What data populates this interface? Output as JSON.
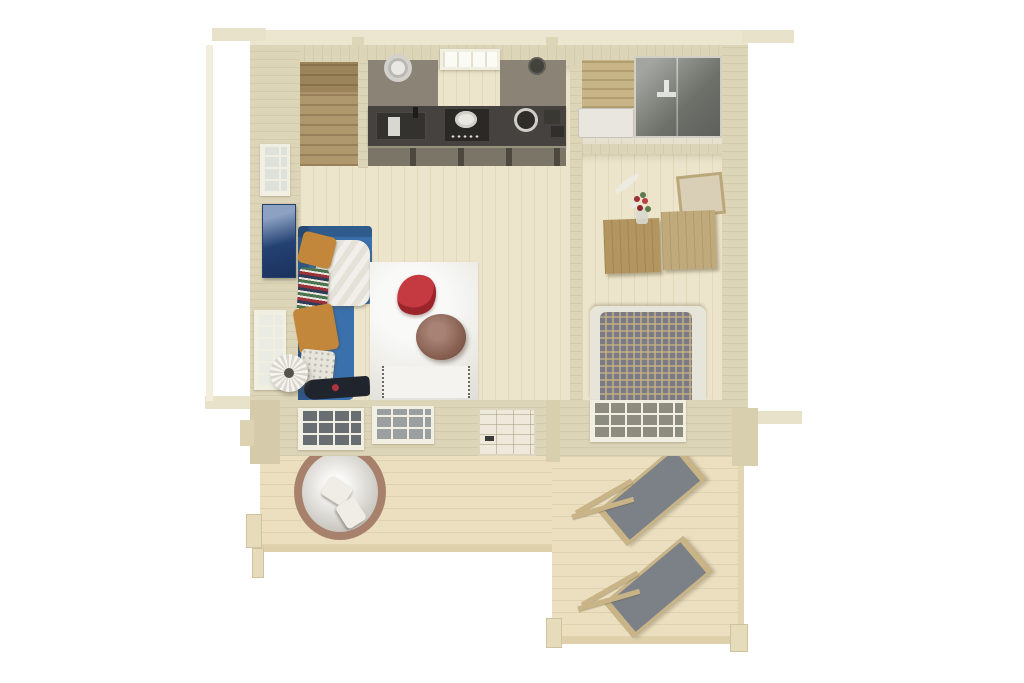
{
  "meta": {
    "description": "Photoreal top-down 3D render of a one-room wooden cabin (log house) floor plan with furnished interior and an L-shaped front terrace deck",
    "canvas": {
      "width": 1024,
      "height": 683
    },
    "background": "#ffffff"
  },
  "palette": {
    "wall": "#ddd5b8",
    "wall_dark": "#d5cbab",
    "roof": "#ece6d0",
    "floor": "#ede5cb",
    "floor_bath": "#e6e1ce",
    "deck": "#ebdfc0",
    "closet": "#b49c71",
    "cabinet": "#8b8376",
    "counter": "#454240",
    "drawer": "#7b7567",
    "shelf_wood": "#c7b588",
    "shower_glass": "#858780",
    "sofa_blue": "#3a70ab",
    "pillow_ochre": "#c3873b",
    "rug": "#ecece7",
    "chair_red": "#c53a41",
    "ottoman_brown": "#8a5947",
    "bed_base": "#e7e4d9",
    "duvet_plaid": "#7b7b87",
    "dresser_a": "#b2955f",
    "dresser_b": "#c0a97b",
    "lounger_fabric": "#7c8187",
    "lounger_frame": "#c9b487",
    "daybed_rim": "#a8816c",
    "daybed_cushion": "#dcdad3",
    "art_blue": "#2c4f86"
  },
  "objects": {
    "rooms": [
      "living-room-with-kitchen",
      "bathroom",
      "bedroom",
      "terrace-deck"
    ],
    "furniture": [
      "kitchen-cabinets",
      "range-hood",
      "kitchen-sink",
      "cooking-hob",
      "kitchen-window",
      "wardrobe-closet",
      "shower-cabin",
      "washbasin",
      "wooden-shelf",
      "dresser",
      "flower-vase",
      "mirror-panel",
      "double-bed-plaid-duvet",
      "blue-corner-sofa",
      "throw-blanket",
      "ochre-pillows",
      "striped-pillow",
      "floor-lamp",
      "area-rug",
      "red-lounge-chair",
      "round-ottoman",
      "guitar",
      "round-wicker-daybed",
      "deck-chair-1",
      "deck-chair-2",
      "front-door",
      "front-windows",
      "left-wall-windows",
      "wall-art"
    ]
  }
}
